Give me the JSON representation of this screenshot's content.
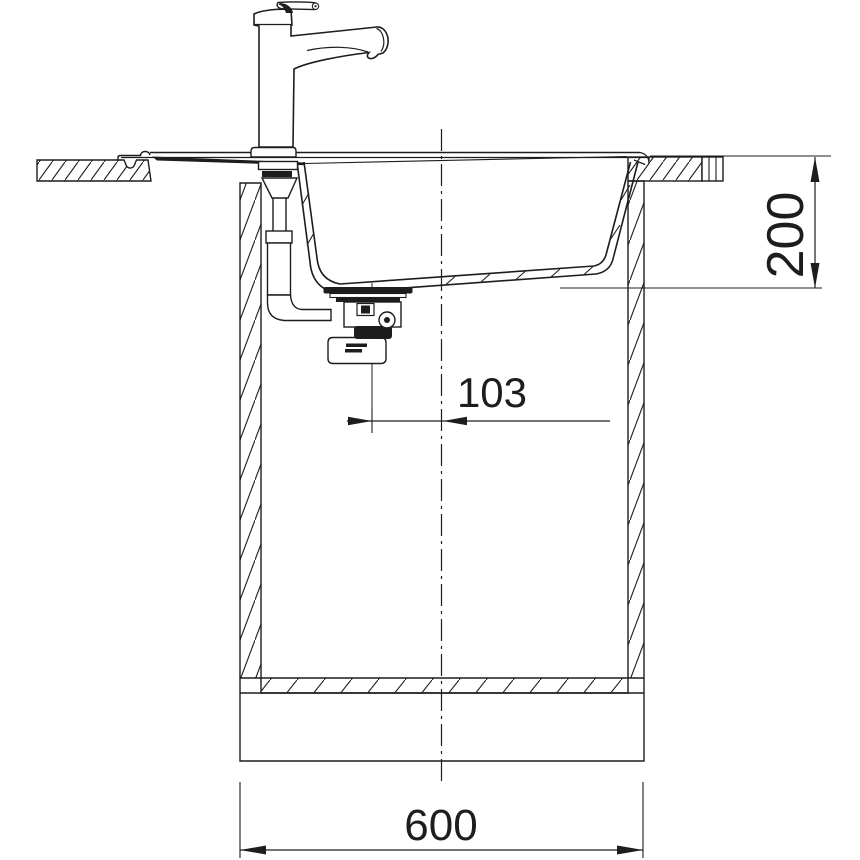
{
  "drawing": {
    "background_color": "#ffffff",
    "line_color": "#1d1d1d",
    "dimensions": {
      "bowl_depth": {
        "value": "200"
      },
      "drain_offset": {
        "value": "103"
      },
      "cabinet_width": {
        "value": "600"
      }
    }
  }
}
